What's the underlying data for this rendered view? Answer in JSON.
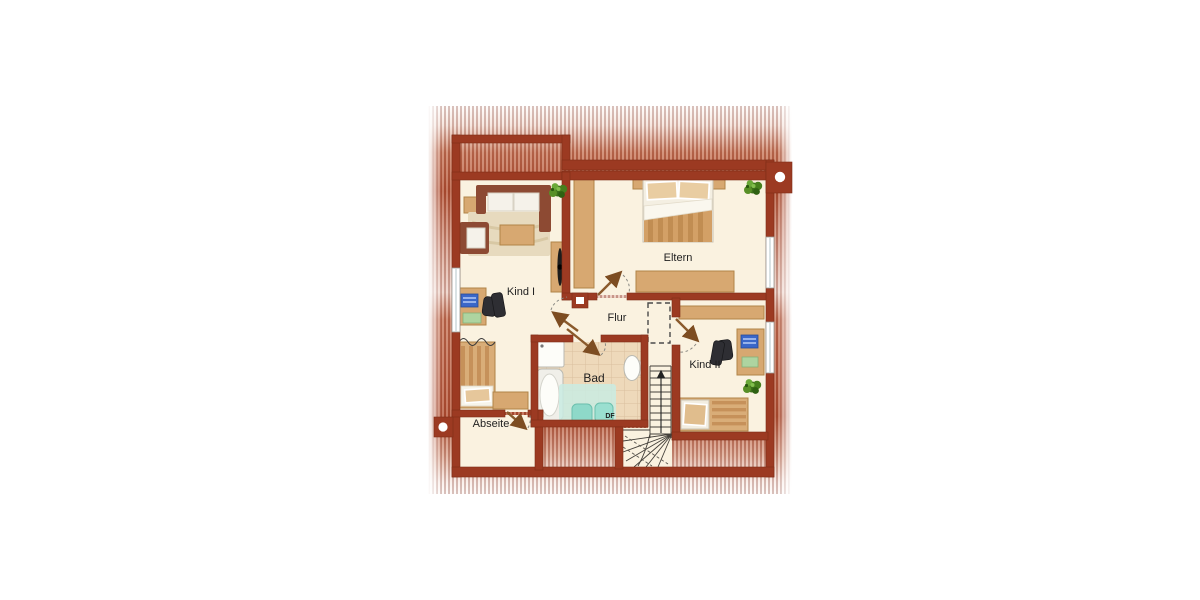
{
  "labels": {
    "room_kind1": "Kind I",
    "room_eltern": "Eltern",
    "room_flur": "Flur",
    "room_bad": "Bad",
    "room_kind2": "Kind II",
    "room_abseite": "Abseite",
    "roof_window": "DF"
  },
  "colors": {
    "wall": "#9c3a22",
    "floor": "#faf2e0",
    "wood": "#d7a871",
    "tile": "#eed9ba",
    "tile_grid": "#d9bf9e",
    "fixture_teal": "#8ed9c9",
    "glass_teal": "#c9ebe2",
    "background_brick": "#b85a3c",
    "sofa_brown": "#8d4a33",
    "plant_green": "#477f1e",
    "window": "#ffffff",
    "label_text": "#1f1f1f"
  },
  "rooms": [
    {
      "id": "kind1",
      "label": "Kind I",
      "furniture": [
        "sofa",
        "armchair",
        "rug",
        "coffee-table",
        "side-table",
        "plant",
        "wardrobe",
        "desk",
        "office-chair",
        "bed"
      ]
    },
    {
      "id": "eltern",
      "label": "Eltern",
      "furniture": [
        "double-bed",
        "wardrobe",
        "dresser",
        "plant"
      ]
    },
    {
      "id": "flur",
      "label": "Flur",
      "furniture": [
        "chimney-dashed-outline"
      ]
    },
    {
      "id": "bad",
      "label": "Bad",
      "furniture": [
        "shower",
        "bathtub",
        "sink",
        "toilet",
        "bidet"
      ]
    },
    {
      "id": "kind2",
      "label": "Kind II",
      "furniture": [
        "shelf",
        "desk",
        "office-chair",
        "bed",
        "plant"
      ]
    },
    {
      "id": "abseite",
      "label": "Abseite",
      "furniture": []
    },
    {
      "id": "stairs",
      "label": "",
      "furniture": [
        "winder-staircase",
        "up-arrow"
      ]
    }
  ]
}
